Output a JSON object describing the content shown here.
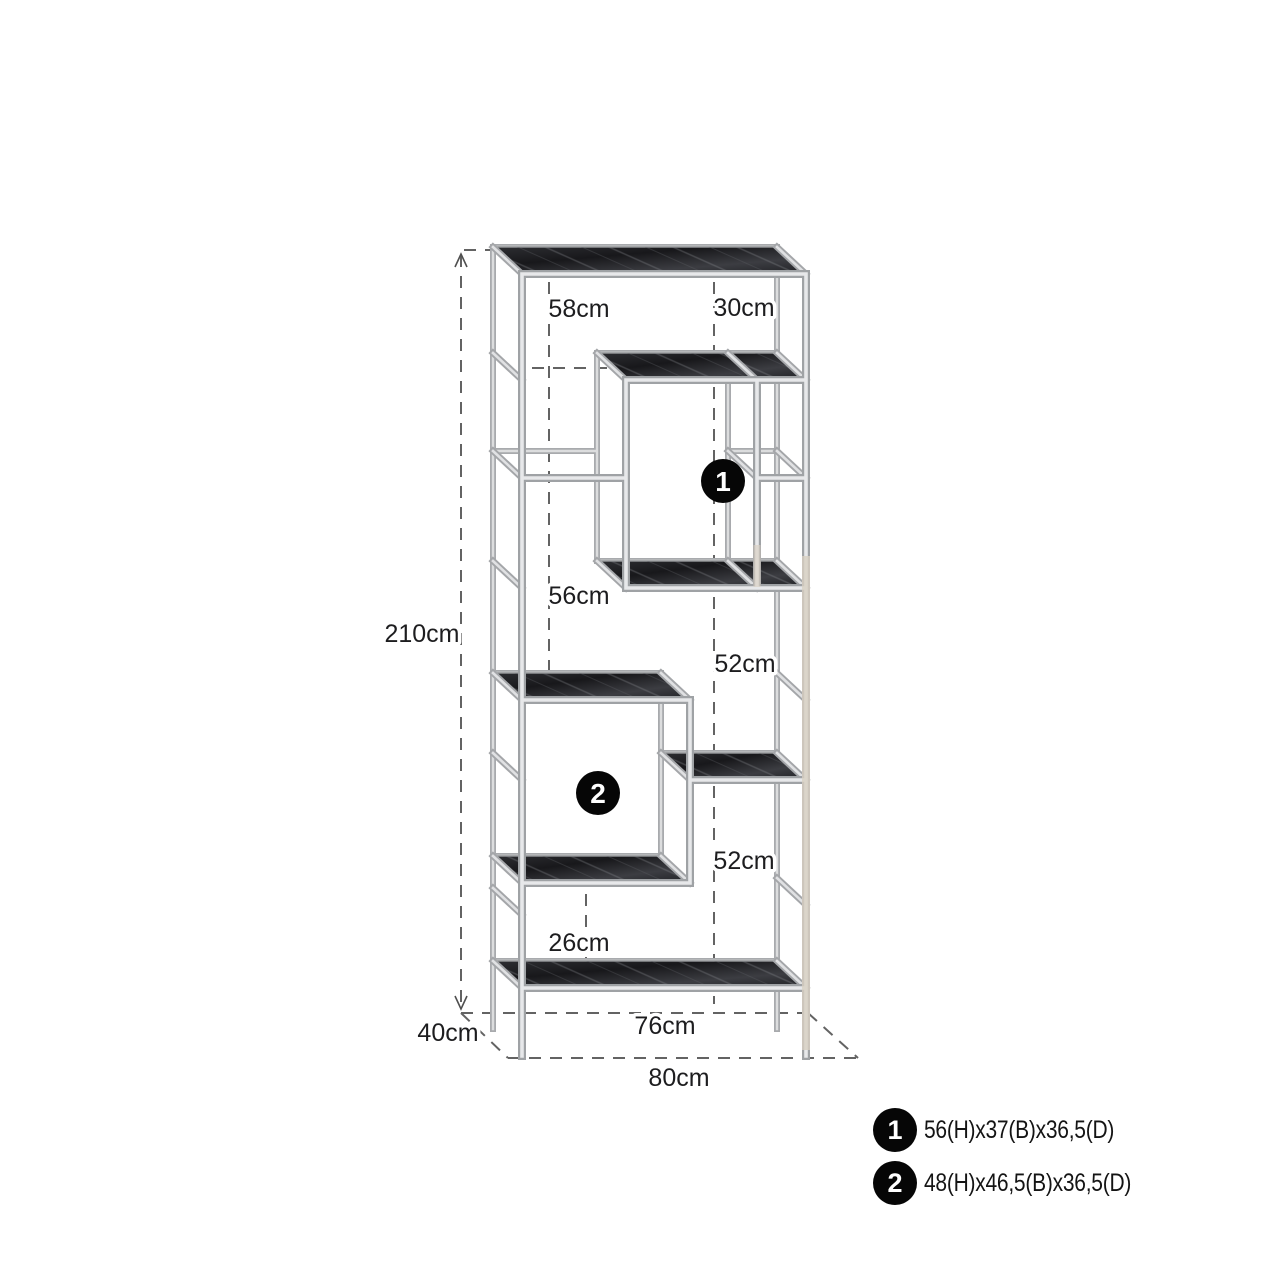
{
  "diagram": {
    "labels": {
      "height": "210cm",
      "top_span_left": "58cm",
      "top_span_right": "30cm",
      "left_mid_span": "56cm",
      "right_span_upper": "52cm",
      "right_span_lower": "52cm",
      "bottom_span": "26cm",
      "base_inner_width": "76cm",
      "base_outer_width": "80cm",
      "base_depth": "40cm"
    },
    "markers": [
      {
        "id": "1"
      },
      {
        "id": "2"
      }
    ],
    "legend": [
      {
        "num": "1",
        "size": "56(H)x37(B)x36,5(D)"
      },
      {
        "num": "2",
        "size": "48(H)x46,5(B)x36,5(D)"
      }
    ],
    "colors": {
      "background": "#ffffff",
      "chrome": "#9fa2a5",
      "chrome_highlight": "#e7e8ea",
      "slab_dark": "#232327",
      "dash": "#636363",
      "text": "#1d1d1f",
      "marker_bg": "#060606",
      "marker_text": "#ffffff"
    }
  }
}
